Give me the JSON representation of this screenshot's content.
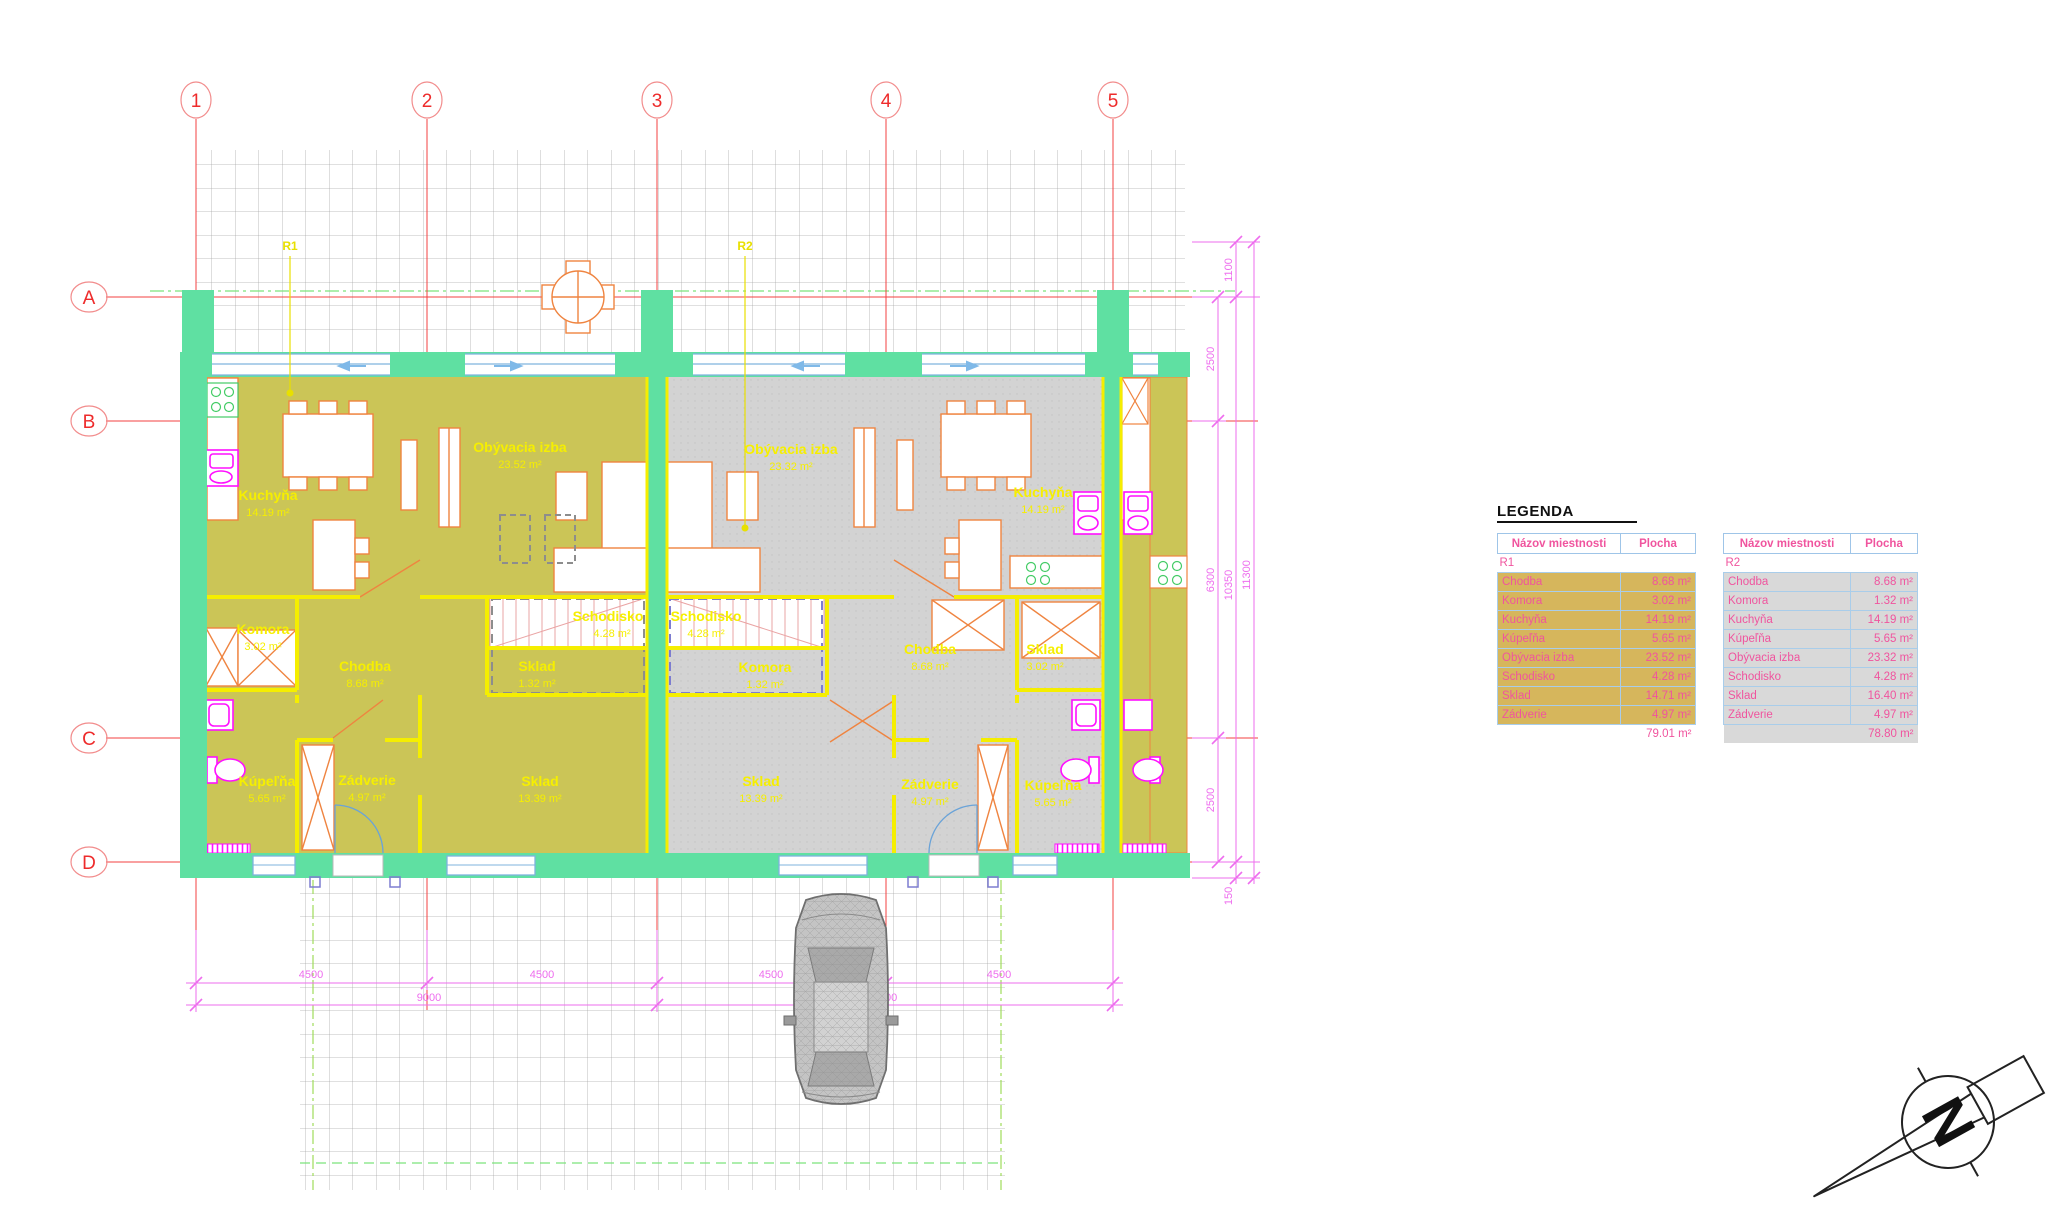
{
  "plan": {
    "axis_columns": [
      "1",
      "2",
      "3",
      "4",
      "5"
    ],
    "axis_rows": [
      "A",
      "B",
      "C",
      "D"
    ],
    "unit_tags": [
      "R1",
      "R2"
    ],
    "r1_rooms": [
      {
        "name": "Kuchyňa",
        "area": "14.19 m²"
      },
      {
        "name": "Obývacia izba",
        "area": "23.52 m²"
      },
      {
        "name": "Komora",
        "area": "3.02 m²"
      },
      {
        "name": "Chodba",
        "area": "8.68 m²"
      },
      {
        "name": "Schodisko",
        "area": "4.28 m²"
      },
      {
        "name": "Sklad",
        "area": "1.32 m²"
      },
      {
        "name": "Kúpeľňa",
        "area": "5.65 m²"
      },
      {
        "name": "Zádverie",
        "area": "4.97 m²"
      },
      {
        "name": "Sklad",
        "area": "13.39 m²"
      }
    ],
    "r2_rooms": [
      {
        "name": "Obývacia izba",
        "area": "23.32 m²"
      },
      {
        "name": "Kuchyňa",
        "area": "14.19 m²"
      },
      {
        "name": "Schodisko",
        "area": "4.28 m²"
      },
      {
        "name": "Komora",
        "area": "1.32 m²"
      },
      {
        "name": "Chodba",
        "area": "8.68 m²"
      },
      {
        "name": "Sklad",
        "area": "3.02 m²"
      },
      {
        "name": "Sklad",
        "area": "13.39 m²"
      },
      {
        "name": "Zádverie",
        "area": "4.97 m²"
      },
      {
        "name": "Kúpeľňa",
        "area": "5.65 m²"
      }
    ],
    "dimensions": {
      "bottom_segments": [
        "4500",
        "4500",
        "4500",
        "4500"
      ],
      "bottom_totals": [
        "9000",
        "9000"
      ],
      "right_inner": [
        "2500",
        "6300",
        "2500"
      ],
      "right_middle": [
        "1100",
        "10350",
        "150"
      ],
      "right_total": "11300"
    }
  },
  "legend": {
    "title": "LEGENDA",
    "tables": [
      {
        "group": "R1",
        "headers": [
          "Názov miestnosti",
          "Plocha"
        ],
        "rows": [
          [
            "Chodba",
            "8.68 m²"
          ],
          [
            "Komora",
            "3.02 m²"
          ],
          [
            "Kuchyňa",
            "14.19 m²"
          ],
          [
            "Kúpeľňa",
            "5.65 m²"
          ],
          [
            "Obývacia izba",
            "23.52 m²"
          ],
          [
            "Schodisko",
            "4.28 m²"
          ],
          [
            "Sklad",
            "14.71 m²"
          ],
          [
            "Zádverie",
            "4.97 m²"
          ]
        ],
        "total": "79.01 m²"
      },
      {
        "group": "R2",
        "headers": [
          "Názov miestnosti",
          "Plocha"
        ],
        "rows": [
          [
            "Chodba",
            "8.68 m²"
          ],
          [
            "Komora",
            "1.32 m²"
          ],
          [
            "Kuchyňa",
            "14.19 m²"
          ],
          [
            "Kúpeľňa",
            "5.65 m²"
          ],
          [
            "Obývacia izba",
            "23.32 m²"
          ],
          [
            "Schodisko",
            "4.28 m²"
          ],
          [
            "Sklad",
            "16.40 m²"
          ],
          [
            "Zádverie",
            "4.97 m²"
          ]
        ],
        "total": "78.80 m²"
      }
    ]
  },
  "compass": {
    "north_label": "N"
  },
  "colors": {
    "wall_green": "#5fe0a2",
    "floor_r1": "#cbc557",
    "floor_r2": "#d3d3d3",
    "wall_yellow": "#f5ee00",
    "dim_magenta": "#ee6dee",
    "axis_red": "#ee2b2b",
    "legend_pink": "#f0549e",
    "fixture_magenta": "#ff10ff",
    "furniture_orange": "#ef8440",
    "window_blue": "#7fb3de"
  }
}
